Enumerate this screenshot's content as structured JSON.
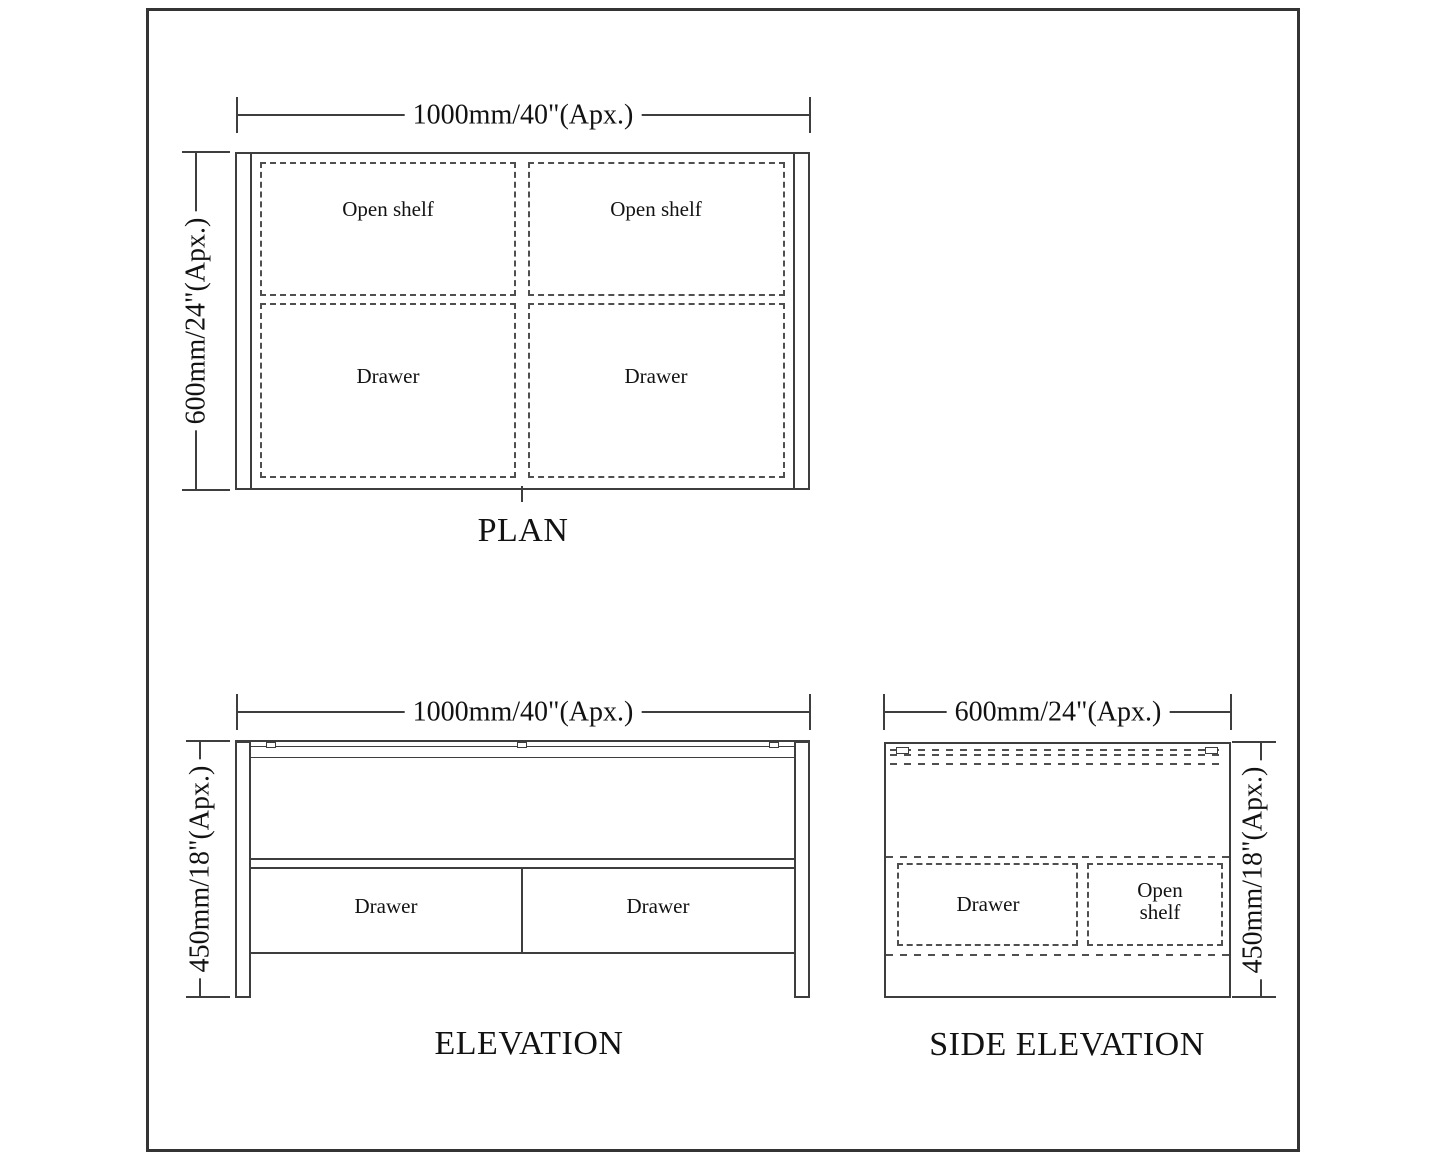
{
  "drawing": {
    "colors": {
      "line": "#3e3e3e",
      "dash": "#4f4f4f",
      "text": "#121212",
      "background": "#ffffff"
    }
  },
  "plan": {
    "title": "PLAN",
    "width_dim": "1000mm/40\"(Apx.)",
    "depth_dim": "600mm/24\"(Apx.)",
    "compartments": [
      {
        "label": "Open shelf"
      },
      {
        "label": "Open shelf"
      },
      {
        "label": "Drawer"
      },
      {
        "label": "Drawer"
      }
    ]
  },
  "elevation": {
    "title": "ELEVATION",
    "width_dim": "1000mm/40\"(Apx.)",
    "height_dim": "450mm/18\"(Apx.)",
    "drawers": [
      {
        "label": "Drawer"
      },
      {
        "label": "Drawer"
      }
    ]
  },
  "side_elevation": {
    "title": "SIDE ELEVATION",
    "width_dim": "600mm/24\"(Apx.)",
    "height_dim": "450mm/18\"(Apx.)",
    "compartments": [
      {
        "label": "Drawer"
      },
      {
        "label": "Open shelf"
      }
    ]
  }
}
